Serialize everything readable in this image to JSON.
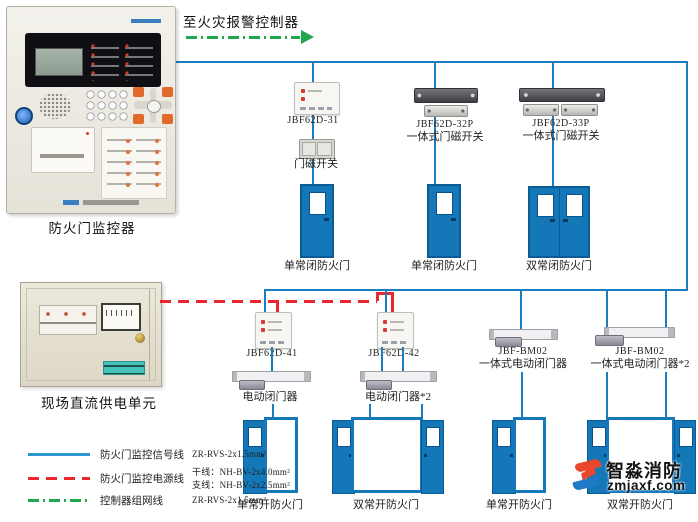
{
  "diagram": {
    "to_fire_alarm_controller": "至火灾报警控制器",
    "monitor_label": "防火门监控器",
    "power_unit_label": "现场直流供电单元"
  },
  "devices": {
    "m31_model": "JBF62D-31",
    "door_magnet_switch": "门磁开关",
    "m32p_model": "JBF62D-32P",
    "m32p_desc": "一体式门磁开关",
    "m33p_model": "JBF62D-33P",
    "m33p_desc": "一体式门磁开关",
    "m41_model": "JBF62D-41",
    "m42_model": "JBF62D-42",
    "closer1_label": "电动闭门器",
    "closer2_label": "电动闭门器*2",
    "bm02a_model": "JBF-BM02",
    "bm02a_desc": "一体式电动闭门器",
    "bm02b_model": "JBF-BM02",
    "bm02b_desc": "一体式电动闭门器*2"
  },
  "doors": {
    "closed_single_1": "单常闭防火门",
    "closed_single_2": "单常闭防火门",
    "closed_double": "双常闭防火门",
    "open_single_1": "单常开防火门",
    "open_double_1": "双常开防火门",
    "open_single_2": "单常开防火门",
    "open_double_2": "双常开防火门"
  },
  "legend": {
    "rows": [
      {
        "label": "防火门监控信号线",
        "spec": "ZR-RVS-2x1.5mm²"
      },
      {
        "label": "防火门监控电源线",
        "spec1": "干线：NH-BV-2x4.0mm²",
        "spec2": "支线：NH-BV-2x2.5mm²"
      },
      {
        "label": "控制器组网线",
        "spec": "ZR-RVS-2x1.5mm²"
      }
    ]
  },
  "watermark": {
    "brand": "智淼消防",
    "site": "zmjaxf.com"
  },
  "colors": {
    "signal_line": "#1b7cc0",
    "power_line": "#e8282c",
    "network_line": "#21a74f",
    "door_blue": "#1377b8"
  }
}
